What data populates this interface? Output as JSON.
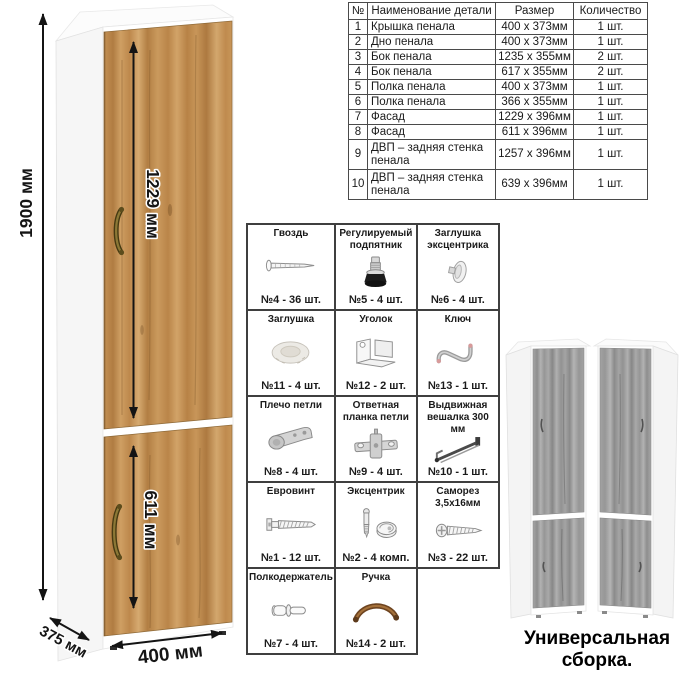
{
  "cabinet_view": {
    "dims": {
      "height": "1900 мм",
      "upper_door": "1229 мм",
      "lower_door": "611 мм",
      "width": "400 мм",
      "depth": "375 мм"
    }
  },
  "parts_table": {
    "headers": [
      "№",
      "Наименование детали",
      "Размер",
      "Количество"
    ],
    "rows": [
      [
        "1",
        "Крышка пенала",
        "400 х 373мм",
        "1 шт."
      ],
      [
        "2",
        "Дно пенала",
        "400 х 373мм",
        "1 шт."
      ],
      [
        "3",
        "Бок пенала",
        "1235 х 355мм",
        "2 шт."
      ],
      [
        "4",
        "Бок пенала",
        "617 х 355мм",
        "2 шт."
      ],
      [
        "5",
        "Полка пенала",
        "400 х 373мм",
        "1 шт."
      ],
      [
        "6",
        "Полка пенала",
        "366 х 355мм",
        "1 шт."
      ],
      [
        "7",
        "Фасад",
        "1229 х 396мм",
        "1 шт."
      ],
      [
        "8",
        "Фасад",
        "611 х 396мм",
        "1 шт."
      ],
      [
        "9",
        "ДВП – задняя стенка пенала",
        "1257 х 396мм",
        "1 шт."
      ],
      [
        "10",
        "ДВП – задняя стенка пенала",
        "639 х 396мм",
        "1 шт."
      ]
    ]
  },
  "hardware": {
    "items": [
      {
        "name": "Гвоздь",
        "count": "№4 - 36 шт.",
        "icon": "nail-icon"
      },
      {
        "name": "Регулируемый подпятник",
        "count": "№5 - 4 шт.",
        "icon": "adjustable-foot-icon"
      },
      {
        "name": "Заглушка эксцентрика",
        "count": "№6 - 4 шт.",
        "icon": "cam-cap-icon"
      },
      {
        "name": "Заглушка",
        "count": "№11 - 4 шт.",
        "icon": "cap-icon"
      },
      {
        "name": "Уголок",
        "count": "№12 - 2 шт.",
        "icon": "corner-bracket-icon"
      },
      {
        "name": "Ключ",
        "count": "№13 - 1 шт.",
        "icon": "key-icon"
      },
      {
        "name": "Плечо петли",
        "count": "№8 - 4 шт.",
        "icon": "hinge-arm-icon"
      },
      {
        "name": "Ответная планка петли",
        "count": "№9 - 4 шт.",
        "icon": "hinge-plate-icon"
      },
      {
        "name": "Выдвижная вешалка 300 мм",
        "count": "№10 - 1 шт.",
        "icon": "pullout-hanger-icon"
      },
      {
        "name": "Евровинт",
        "count": "№1 - 12 шт.",
        "icon": "euro-screw-icon"
      },
      {
        "name": "Эксцентрик",
        "count": "№2 - 4 комп.",
        "icon": "cam-lock-icon"
      },
      {
        "name": "Саморез 3,5х16мм",
        "count": "№3 - 22 шт.",
        "icon": "screw-icon"
      },
      {
        "name": "Полкодержатель",
        "count": "№7 - 4 шт.",
        "icon": "shelf-pin-icon"
      },
      {
        "name": "Ручка",
        "count": "№14 - 2 шт.",
        "icon": "handle-icon"
      }
    ]
  },
  "assembly": {
    "caption": "Универсальная сборка."
  },
  "colors": {
    "wood": "#c3914f",
    "gray_wood": "#9d9d9d",
    "handle_bronze": "#7a5526",
    "grid_border": "#3f3f3f"
  }
}
